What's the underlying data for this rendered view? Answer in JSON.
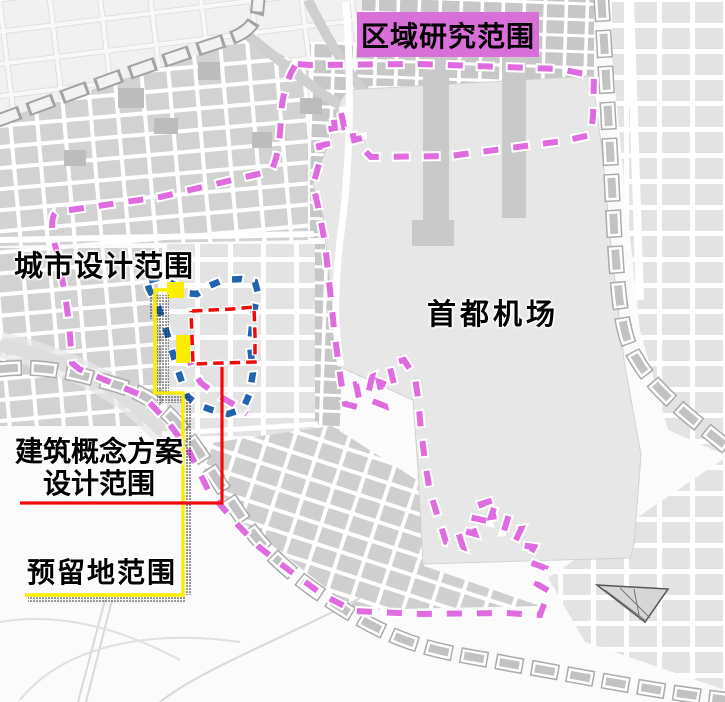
{
  "page": {
    "type": "urban-planning-scope-map",
    "width": 725,
    "height": 702
  },
  "labels": {
    "region_research": {
      "text": "区域研究范围",
      "bg_color": "#d96fd9",
      "text_color": "#000000"
    },
    "urban_design": {
      "text": "城市设计范围"
    },
    "airport": {
      "text": "首都机场"
    },
    "concept_design": {
      "line1": "建筑概念方案",
      "line2": "设计范围"
    },
    "reserved_land": {
      "text": "预留地范围"
    }
  },
  "boundaries": {
    "region_research": {
      "label": "区域研究范围",
      "color": "#e06ae0",
      "style": "dashed"
    },
    "urban_design": {
      "label": "城市设计范围",
      "color": "#2263b0",
      "style": "dashed"
    },
    "concept_design": {
      "label": "建筑概念方案设计范围",
      "color": "#f20a0a",
      "style": "dashed"
    },
    "reserved_land": {
      "label": "预留地范围",
      "color": "#fdee00",
      "style": "solid-with-dotted-edge"
    }
  }
}
